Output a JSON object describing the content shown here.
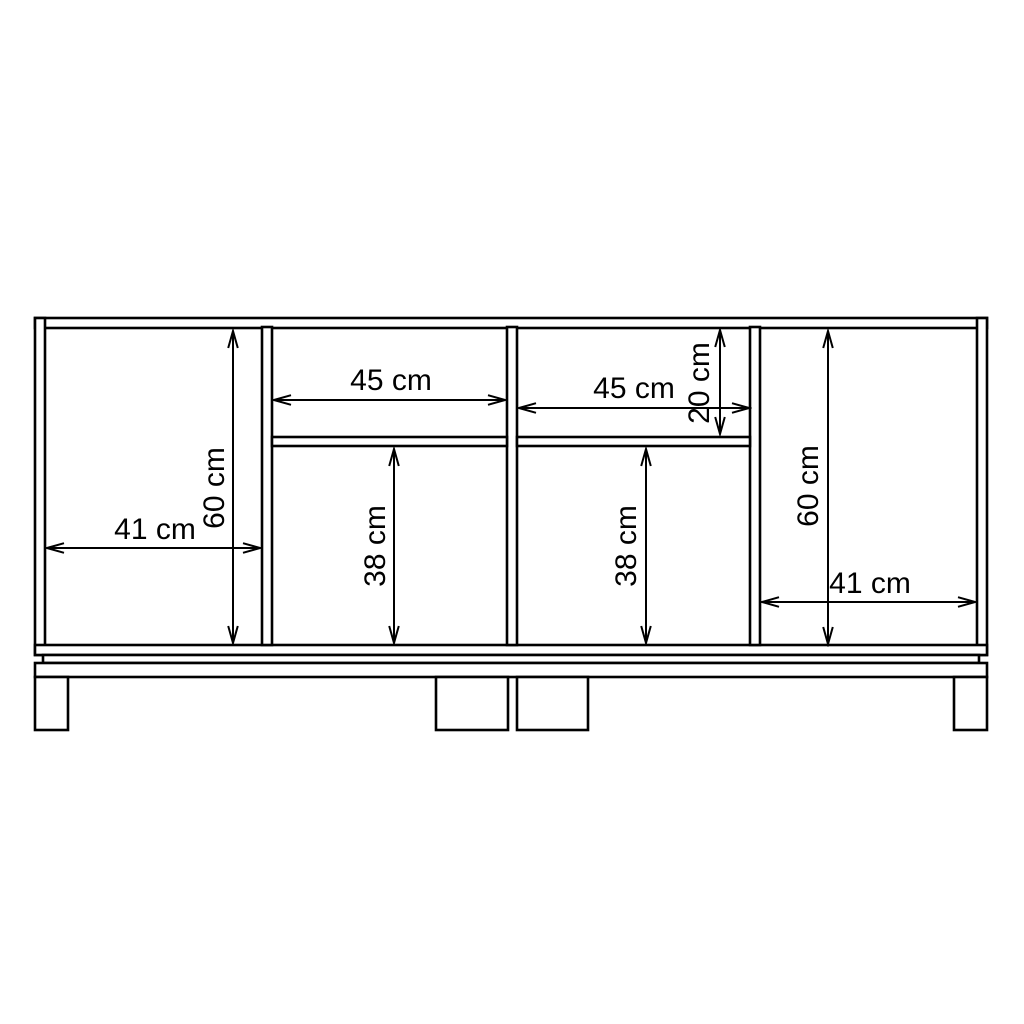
{
  "meta": {
    "title": "Sideboard front elevation dimension drawing",
    "background_color": "#ffffff",
    "line_color": "#000000",
    "text_color": "#000000",
    "unit": "cm"
  },
  "annotations": [
    {
      "id": "left-compartment-width",
      "label": "41 cm",
      "value": 41,
      "orientation": "horizontal"
    },
    {
      "id": "left-compartment-height",
      "label": "60 cm",
      "value": 60,
      "orientation": "vertical"
    },
    {
      "id": "upper-left-niche-width",
      "label": "45 cm",
      "value": 45,
      "orientation": "horizontal"
    },
    {
      "id": "lower-left-compartment-height",
      "label": "38 cm",
      "value": 38,
      "orientation": "vertical"
    },
    {
      "id": "upper-right-niche-width",
      "label": "45 cm",
      "value": 45,
      "orientation": "horizontal"
    },
    {
      "id": "upper-right-niche-height",
      "label": "20 cm",
      "value": 20,
      "orientation": "vertical"
    },
    {
      "id": "lower-right-compartment-height",
      "label": "38 cm",
      "value": 38,
      "orientation": "vertical"
    },
    {
      "id": "right-compartment-height",
      "label": "60 cm",
      "value": 60,
      "orientation": "vertical"
    },
    {
      "id": "right-compartment-width",
      "label": "41 cm",
      "value": 41,
      "orientation": "horizontal"
    }
  ]
}
